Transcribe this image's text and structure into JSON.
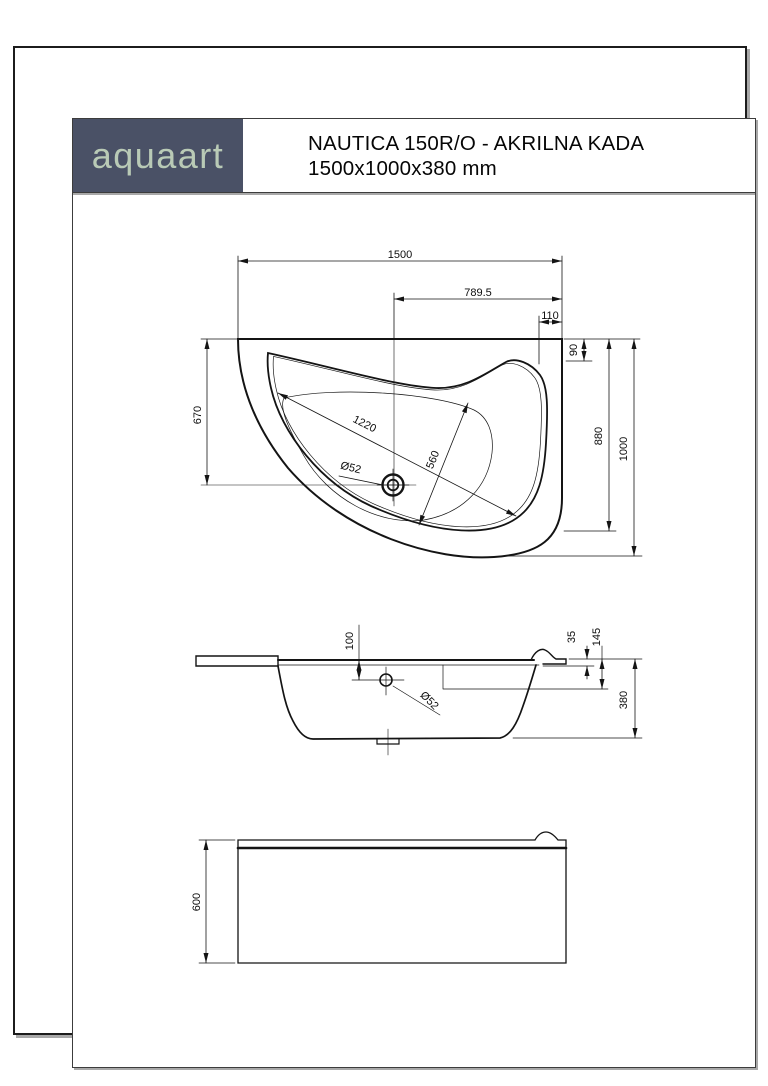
{
  "header": {
    "logo_text": "aquaart",
    "title_line1": "NAUTICA 150R/O - AKRILNA KADA",
    "title_line2": "1500x1000x380 mm"
  },
  "colors": {
    "logo_bg": "#4a5166",
    "logo_text": "#b9cab6",
    "line": "#141414",
    "shadow": "#a8a8a8"
  },
  "dims": {
    "top": {
      "overall_width": "1500",
      "drain_offset": "789.5",
      "headrest_inset": "110",
      "headrest_depth": "90",
      "drain_from_front": "670",
      "basin_diagonal": "1220",
      "basin_width": "560",
      "drain_dia": "Ø52",
      "side_depth": "880",
      "overall_depth": "1000"
    },
    "side": {
      "drain_below_rim": "100",
      "drain_dia": "Ø52",
      "rim_thickness": "35",
      "headrest_drop": "145",
      "overall_height": "380"
    },
    "front": {
      "panel_height": "600"
    }
  }
}
